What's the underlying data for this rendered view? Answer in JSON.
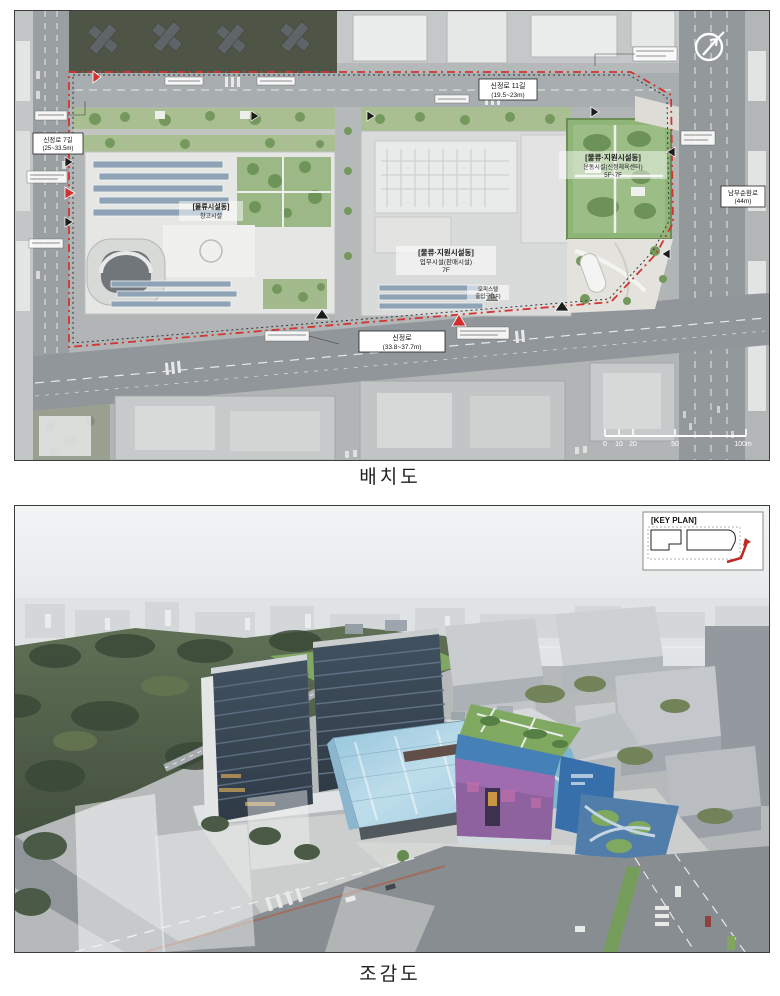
{
  "page": {
    "background": "#ffffff"
  },
  "figures": {
    "site_plan": {
      "caption": "배치도",
      "roads": [
        {
          "name": "신정로 11길",
          "dim": "(19.5~23m)"
        },
        {
          "name": "남부순환로",
          "dim": "(44m)"
        },
        {
          "name": "신정로 7길",
          "dim": "(25~33.5m)"
        },
        {
          "name": "신정로",
          "dim": "(33.8~37.7m)"
        }
      ],
      "buildings": [
        {
          "title": "[물류·지원시설동]",
          "use": "업무시설(판매시설)",
          "floors": "7F"
        },
        {
          "title": "[물류·지원시설동]",
          "use": "운동시설(신정체육센터)",
          "floors": "5F~7F"
        },
        {
          "title": "[물류시설동]",
          "use": "창고시설",
          "floors": ""
        }
      ],
      "entrance_note": {
        "line1": "오피스텔",
        "line2": "출입구(1F)"
      },
      "scale_bar": {
        "ticks": [
          "0",
          "10",
          "20",
          "50",
          "100m"
        ]
      },
      "compass": "north-arrow",
      "boundary_color": "#d23430"
    },
    "birds_eye": {
      "caption": "조감도",
      "key_plan_title": "[KEY PLAN]",
      "colors": {
        "glass_facade": "#a9cfe2",
        "purple_facade": "#8a5b9c",
        "blue_facade": "#2f6aa8",
        "green_roof": "#7aa55b",
        "tower_glass": "#2e3b49"
      }
    }
  }
}
